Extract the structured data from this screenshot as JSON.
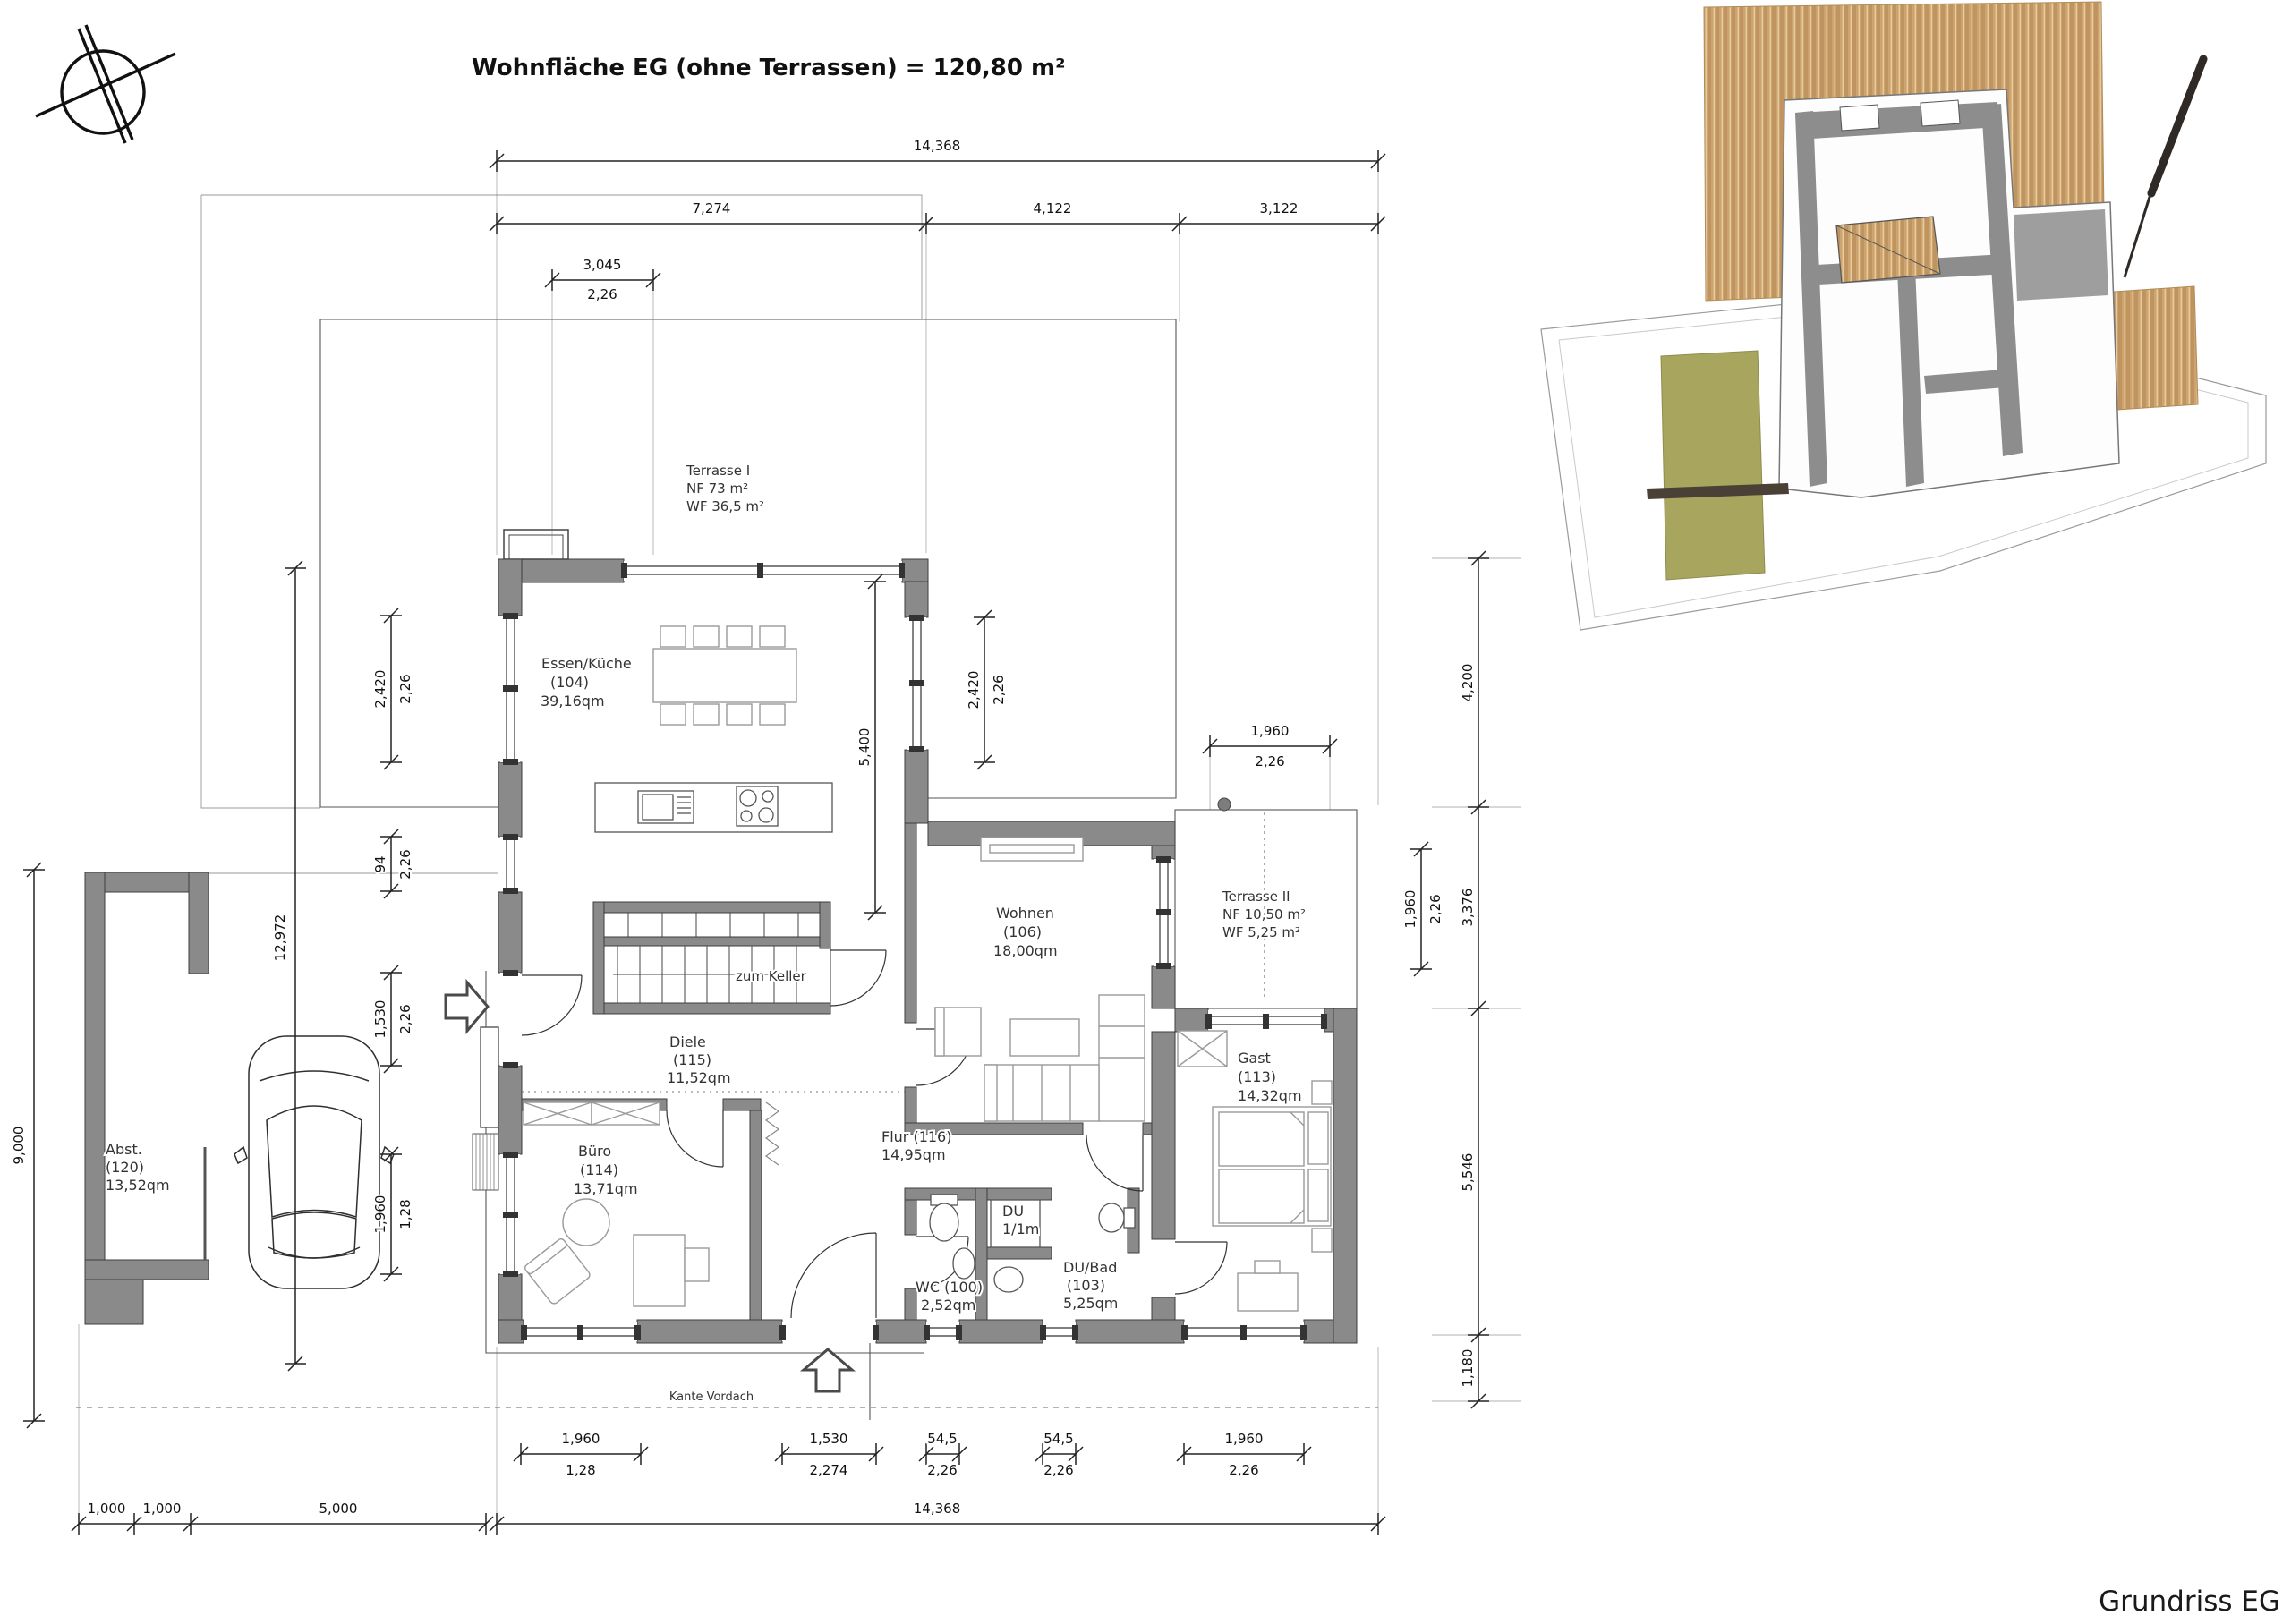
{
  "title": "Wohnfläche EG (ohne Terrassen) = 120,80 m²",
  "plan_name": "Grundriss EG",
  "annotations": {
    "zum_keller": "zum Keller",
    "kante_vordach": "Kante Vordach"
  },
  "rooms": {
    "terrasse1": {
      "name": "Terrasse I",
      "l2": "NF 73 m²",
      "l3": "WF 36,5 m²"
    },
    "kueche": {
      "name": "Essen/Küche",
      "l2": "(104)",
      "l3": "39,16qm"
    },
    "wohnen": {
      "name": "Wohnen",
      "l2": "(106)",
      "l3": "18,00qm"
    },
    "terrasse2": {
      "name": "Terrasse II",
      "l2": "NF 10,50 m²",
      "l3": "WF 5,25 m²"
    },
    "gast": {
      "name": "Gast",
      "l2": "(113)",
      "l3": "14,32qm"
    },
    "diele": {
      "name": "Diele",
      "l2": "(115)",
      "l3": "11,52qm"
    },
    "buero": {
      "name": "Büro",
      "l2": "(114)",
      "l3": "13,71qm"
    },
    "flur": {
      "name": "Flur (116)",
      "l2": "14,95qm"
    },
    "wc": {
      "name": "WC (100)",
      "l2": "2,52qm"
    },
    "du": {
      "name": "DU",
      "l2": "1/1m"
    },
    "dubad": {
      "name": "DU/Bad",
      "l2": "(103)",
      "l3": "5,25qm"
    },
    "abst": {
      "name": "Abst.",
      "l2": "(120)",
      "l3": "13,52qm"
    }
  },
  "dims": {
    "total_w": "14,368",
    "w1": "7,274",
    "w2": "4,122",
    "w3": "3,122",
    "sub_top": "3,045",
    "sub_top_h": "2,26",
    "h_left": "9,000",
    "h_left2": "12,972",
    "ww1": "2,420",
    "ww1h": "2,26",
    "ww2": "94",
    "ww2h": "2,26",
    "ww3": "1,530",
    "ww3h": "2,26",
    "ww4": "1,960",
    "ww4h": "1,28",
    "ew1": "2,420",
    "ew1h": "2,26",
    "interior": "5,400",
    "r1": "4,200",
    "r2": "3,376",
    "r3": "5,546",
    "r4": "1,180",
    "rs": "1,960",
    "rsh": "2,26",
    "t2": "1,960",
    "t2h": "2,26",
    "sw1": "1,960",
    "sw1h": "1,28",
    "sw2": "1,530",
    "sw2h": "2,274",
    "sw3": "54,5",
    "sw3h": "2,26",
    "sw4": "54,5",
    "sw4h": "2,26",
    "sw5": "1,960",
    "sw5h": "2,26",
    "b1": "1,000",
    "b2": "1,000",
    "b3": "5,000",
    "b4": "14,368"
  }
}
